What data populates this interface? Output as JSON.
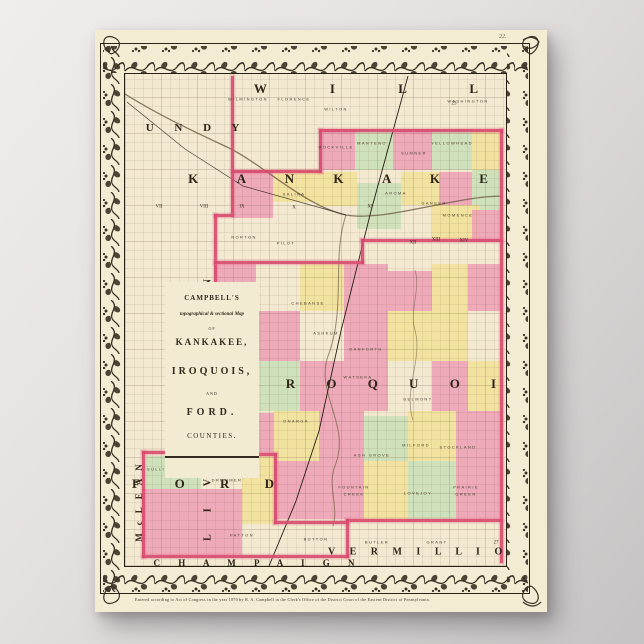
{
  "poster": {
    "paper_color": "#f4ebd3",
    "plate_number": "22.",
    "credit_line": "Entered according to Act of Congress in the year 1870 by  R. A. Campbell  in the Clerk's Office of the District Court of the Eastern District of Pennsylvania."
  },
  "cartouche": {
    "line1": "CAMPBELL'S",
    "line2": "topographical & sectional Map",
    "line3": "OF",
    "line4": "KANKAKEE,",
    "line5": "IROQUOIS,",
    "line6": "AND",
    "line7": "FORD.",
    "line8": "COUNTIES."
  },
  "map": {
    "colors": {
      "paper": "#f2e9d0",
      "ink": "#3b3126",
      "pink": "#ef9fb5",
      "yellow": "#f2e096",
      "green": "#c9dfb6",
      "boundary_red": "#d84a6e",
      "water": "#6e5d42"
    },
    "county_labels": [
      {
        "text": "W  I  L  L",
        "x": 285,
        "y": 58,
        "size": 13,
        "ls": 30,
        "rot": 0
      },
      {
        "text": "G R U N D Y",
        "x": 72,
        "y": 97,
        "size": 11,
        "ls": 9,
        "rot": 0
      },
      {
        "text": "K A N K A K E E",
        "x": 275,
        "y": 148,
        "size": 13,
        "ls": 18,
        "rot": 0
      },
      {
        "text": "I R O Q U O I S",
        "x": 303,
        "y": 353,
        "size": 13,
        "ls": 14,
        "rot": 0
      },
      {
        "text": "F O R D",
        "x": 115,
        "y": 453,
        "size": 13,
        "ls": 16,
        "rot": 0
      },
      {
        "text": "C H A M P A I G N",
        "x": 162,
        "y": 532,
        "size": 9,
        "ls": 8,
        "rot": 0
      },
      {
        "text": "V E R M I L L I O N",
        "x": 333,
        "y": 521,
        "size": 10,
        "ls": 6,
        "rot": 0
      },
      {
        "text": "LIVINGSTON",
        "x": 112,
        "y": 368,
        "size": 10,
        "ls": 22,
        "rot": -90
      },
      {
        "text": "McLEAN",
        "x": 43,
        "y": 468,
        "size": 9,
        "ls": 8,
        "rot": -90
      }
    ],
    "township_labels": [
      {
        "text": "WILMINGTON",
        "x": 152,
        "y": 68
      },
      {
        "text": "FLORENCE",
        "x": 198,
        "y": 68
      },
      {
        "text": "WILTON",
        "x": 240,
        "y": 78
      },
      {
        "text": "WASHINGTON",
        "x": 372,
        "y": 70
      },
      {
        "text": "ROCKVILLE",
        "x": 240,
        "y": 116
      },
      {
        "text": "MANTENO",
        "x": 276,
        "y": 112
      },
      {
        "text": "SUMNER",
        "x": 318,
        "y": 122
      },
      {
        "text": "YELLOWHEAD",
        "x": 356,
        "y": 112
      },
      {
        "text": "GANEER",
        "x": 338,
        "y": 172
      },
      {
        "text": "MOMENCE",
        "x": 362,
        "y": 184
      },
      {
        "text": "SALINA",
        "x": 198,
        "y": 163
      },
      {
        "text": "NORTON",
        "x": 148,
        "y": 206
      },
      {
        "text": "PILOT",
        "x": 190,
        "y": 212
      },
      {
        "text": "AROMA",
        "x": 300,
        "y": 162
      },
      {
        "text": "CHEBANSE",
        "x": 212,
        "y": 272
      },
      {
        "text": "ASHKUM",
        "x": 230,
        "y": 302
      },
      {
        "text": "DANFORTH",
        "x": 270,
        "y": 318
      },
      {
        "text": "ONARGA",
        "x": 200,
        "y": 390
      },
      {
        "text": "BRENTON",
        "x": 143,
        "y": 340
      },
      {
        "text": "TOLEDO",
        "x": 150,
        "y": 353
      },
      {
        "text": "WATSEKA",
        "x": 262,
        "y": 346
      },
      {
        "text": "BELMONT",
        "x": 322,
        "y": 368
      },
      {
        "text": "MILFORD",
        "x": 320,
        "y": 414
      },
      {
        "text": "STOCKLAND",
        "x": 362,
        "y": 416
      },
      {
        "text": "ASH GROVE",
        "x": 276,
        "y": 424
      },
      {
        "text": "FOUNTAIN",
        "x": 258,
        "y": 456
      },
      {
        "text": "CREEK",
        "x": 258,
        "y": 463
      },
      {
        "text": "LOVEJOY",
        "x": 322,
        "y": 462
      },
      {
        "text": "PRAIRIE",
        "x": 370,
        "y": 456
      },
      {
        "text": "GREEN",
        "x": 370,
        "y": 463
      },
      {
        "text": "SULLIVAN",
        "x": 66,
        "y": 438
      },
      {
        "text": "PEACH",
        "x": 114,
        "y": 430
      },
      {
        "text": "ORCHARD",
        "x": 114,
        "y": 437
      },
      {
        "text": "DRUMMER",
        "x": 131,
        "y": 449
      },
      {
        "text": "LYMAN",
        "x": 150,
        "y": 408
      },
      {
        "text": "PATTON",
        "x": 146,
        "y": 504
      },
      {
        "text": "BUTTON",
        "x": 220,
        "y": 508
      },
      {
        "text": "BUTLER",
        "x": 281,
        "y": 511
      },
      {
        "text": "GRANT",
        "x": 341,
        "y": 511
      }
    ],
    "range_numerals": [
      {
        "text": "VII",
        "x": 63,
        "y": 176
      },
      {
        "text": "VIII",
        "x": 108,
        "y": 176
      },
      {
        "text": "IX",
        "x": 146,
        "y": 176
      },
      {
        "text": "X",
        "x": 198,
        "y": 177
      },
      {
        "text": "XI",
        "x": 274,
        "y": 176
      },
      {
        "text": "XII",
        "x": 317,
        "y": 212
      },
      {
        "text": "XIII",
        "x": 340,
        "y": 209
      },
      {
        "text": "XIV",
        "x": 368,
        "y": 210
      },
      {
        "text": "23",
        "x": 358,
        "y": 73
      },
      {
        "text": "27",
        "x": 400,
        "y": 512
      }
    ],
    "boundary_segments": [
      {
        "x": 135,
        "y": 45,
        "w": 3,
        "h": 138
      },
      {
        "x": 118,
        "y": 183,
        "w": 20,
        "h": 3
      },
      {
        "x": 118,
        "y": 183,
        "w": 3,
        "h": 239
      },
      {
        "x": 223,
        "y": 98,
        "w": 184,
        "h": 3
      },
      {
        "x": 223,
        "y": 98,
        "w": 3,
        "h": 44
      },
      {
        "x": 135,
        "y": 139,
        "w": 91,
        "h": 3
      },
      {
        "x": 404,
        "y": 98,
        "w": 3,
        "h": 434
      },
      {
        "x": 118,
        "y": 230,
        "w": 150,
        "h": 3
      },
      {
        "x": 265,
        "y": 208,
        "w": 3,
        "h": 25
      },
      {
        "x": 265,
        "y": 208,
        "w": 142,
        "h": 3
      },
      {
        "x": 250,
        "y": 488,
        "w": 157,
        "h": 3
      },
      {
        "x": 118,
        "y": 363,
        "w": 30,
        "h": 3
      },
      {
        "x": 145,
        "y": 363,
        "w": 3,
        "h": 62
      },
      {
        "x": 145,
        "y": 422,
        "w": 36,
        "h": 3
      },
      {
        "x": 178,
        "y": 422,
        "w": 3,
        "h": 71
      },
      {
        "x": 178,
        "y": 490,
        "w": 75,
        "h": 3
      },
      {
        "x": 46,
        "y": 420,
        "w": 3,
        "h": 107
      },
      {
        "x": 46,
        "y": 420,
        "w": 75,
        "h": 3
      },
      {
        "x": 46,
        "y": 524,
        "w": 207,
        "h": 3
      },
      {
        "x": 250,
        "y": 488,
        "w": 3,
        "h": 39
      }
    ],
    "patches": [
      {
        "x": 223,
        "y": 98,
        "w": 36,
        "h": 41,
        "c": "pink"
      },
      {
        "x": 259,
        "y": 98,
        "w": 38,
        "h": 41,
        "c": "green"
      },
      {
        "x": 297,
        "y": 98,
        "w": 39,
        "h": 41,
        "c": "pink"
      },
      {
        "x": 336,
        "y": 98,
        "w": 40,
        "h": 41,
        "c": "green"
      },
      {
        "x": 376,
        "y": 98,
        "w": 28,
        "h": 41,
        "c": "yellow"
      },
      {
        "x": 135,
        "y": 139,
        "w": 42,
        "h": 48,
        "c": "pink"
      },
      {
        "x": 177,
        "y": 139,
        "w": 44,
        "h": 32,
        "c": "yellow"
      },
      {
        "x": 221,
        "y": 141,
        "w": 40,
        "h": 34,
        "c": "yellow"
      },
      {
        "x": 261,
        "y": 152,
        "w": 44,
        "h": 46,
        "c": "green"
      },
      {
        "x": 305,
        "y": 141,
        "w": 38,
        "h": 33,
        "c": "yellow"
      },
      {
        "x": 343,
        "y": 141,
        "w": 33,
        "h": 34,
        "c": "pink"
      },
      {
        "x": 376,
        "y": 139,
        "w": 28,
        "h": 40,
        "c": "green"
      },
      {
        "x": 336,
        "y": 174,
        "w": 48,
        "h": 34,
        "c": "yellow"
      },
      {
        "x": 376,
        "y": 179,
        "w": 28,
        "h": 31,
        "c": "pink"
      },
      {
        "x": 118,
        "y": 233,
        "w": 42,
        "h": 47,
        "c": "pink"
      },
      {
        "x": 204,
        "y": 233,
        "w": 44,
        "h": 47,
        "c": "yellow"
      },
      {
        "x": 248,
        "y": 233,
        "w": 44,
        "h": 47,
        "c": "pink"
      },
      {
        "x": 292,
        "y": 240,
        "w": 44,
        "h": 40,
        "c": "pink"
      },
      {
        "x": 336,
        "y": 233,
        "w": 36,
        "h": 47,
        "c": "yellow"
      },
      {
        "x": 372,
        "y": 233,
        "w": 32,
        "h": 47,
        "c": "pink"
      },
      {
        "x": 118,
        "y": 280,
        "w": 42,
        "h": 50,
        "c": "green"
      },
      {
        "x": 160,
        "y": 280,
        "w": 44,
        "h": 50,
        "c": "pink"
      },
      {
        "x": 248,
        "y": 280,
        "w": 44,
        "h": 50,
        "c": "pink"
      },
      {
        "x": 292,
        "y": 280,
        "w": 44,
        "h": 50,
        "c": "yellow"
      },
      {
        "x": 336,
        "y": 280,
        "w": 36,
        "h": 50,
        "c": "yellow"
      },
      {
        "x": 118,
        "y": 330,
        "w": 42,
        "h": 50,
        "c": "pink"
      },
      {
        "x": 160,
        "y": 330,
        "w": 44,
        "h": 50,
        "c": "green"
      },
      {
        "x": 204,
        "y": 330,
        "w": 44,
        "h": 50,
        "c": "pink"
      },
      {
        "x": 248,
        "y": 330,
        "w": 44,
        "h": 50,
        "c": "pink"
      },
      {
        "x": 336,
        "y": 330,
        "w": 36,
        "h": 50,
        "c": "pink"
      },
      {
        "x": 372,
        "y": 330,
        "w": 32,
        "h": 50,
        "c": "yellow"
      },
      {
        "x": 145,
        "y": 382,
        "w": 33,
        "h": 40,
        "c": "pink"
      },
      {
        "x": 178,
        "y": 380,
        "w": 45,
        "h": 50,
        "c": "yellow"
      },
      {
        "x": 223,
        "y": 380,
        "w": 45,
        "h": 50,
        "c": "pink"
      },
      {
        "x": 268,
        "y": 385,
        "w": 44,
        "h": 45,
        "c": "green"
      },
      {
        "x": 312,
        "y": 380,
        "w": 48,
        "h": 50,
        "c": "yellow"
      },
      {
        "x": 360,
        "y": 380,
        "w": 44,
        "h": 50,
        "c": "pink"
      },
      {
        "x": 178,
        "y": 430,
        "w": 45,
        "h": 58,
        "c": "pink"
      },
      {
        "x": 223,
        "y": 430,
        "w": 45,
        "h": 58,
        "c": "pink"
      },
      {
        "x": 268,
        "y": 430,
        "w": 44,
        "h": 58,
        "c": "yellow"
      },
      {
        "x": 312,
        "y": 430,
        "w": 48,
        "h": 58,
        "c": "green"
      },
      {
        "x": 360,
        "y": 430,
        "w": 44,
        "h": 58,
        "c": "pink"
      },
      {
        "x": 118,
        "y": 365,
        "w": 27,
        "h": 57,
        "c": "pink"
      },
      {
        "x": 146,
        "y": 425,
        "w": 32,
        "h": 68,
        "c": "yellow"
      },
      {
        "x": 50,
        "y": 425,
        "w": 55,
        "h": 33,
        "c": "green"
      },
      {
        "x": 46,
        "y": 458,
        "w": 100,
        "h": 66,
        "c": "pink"
      }
    ]
  }
}
